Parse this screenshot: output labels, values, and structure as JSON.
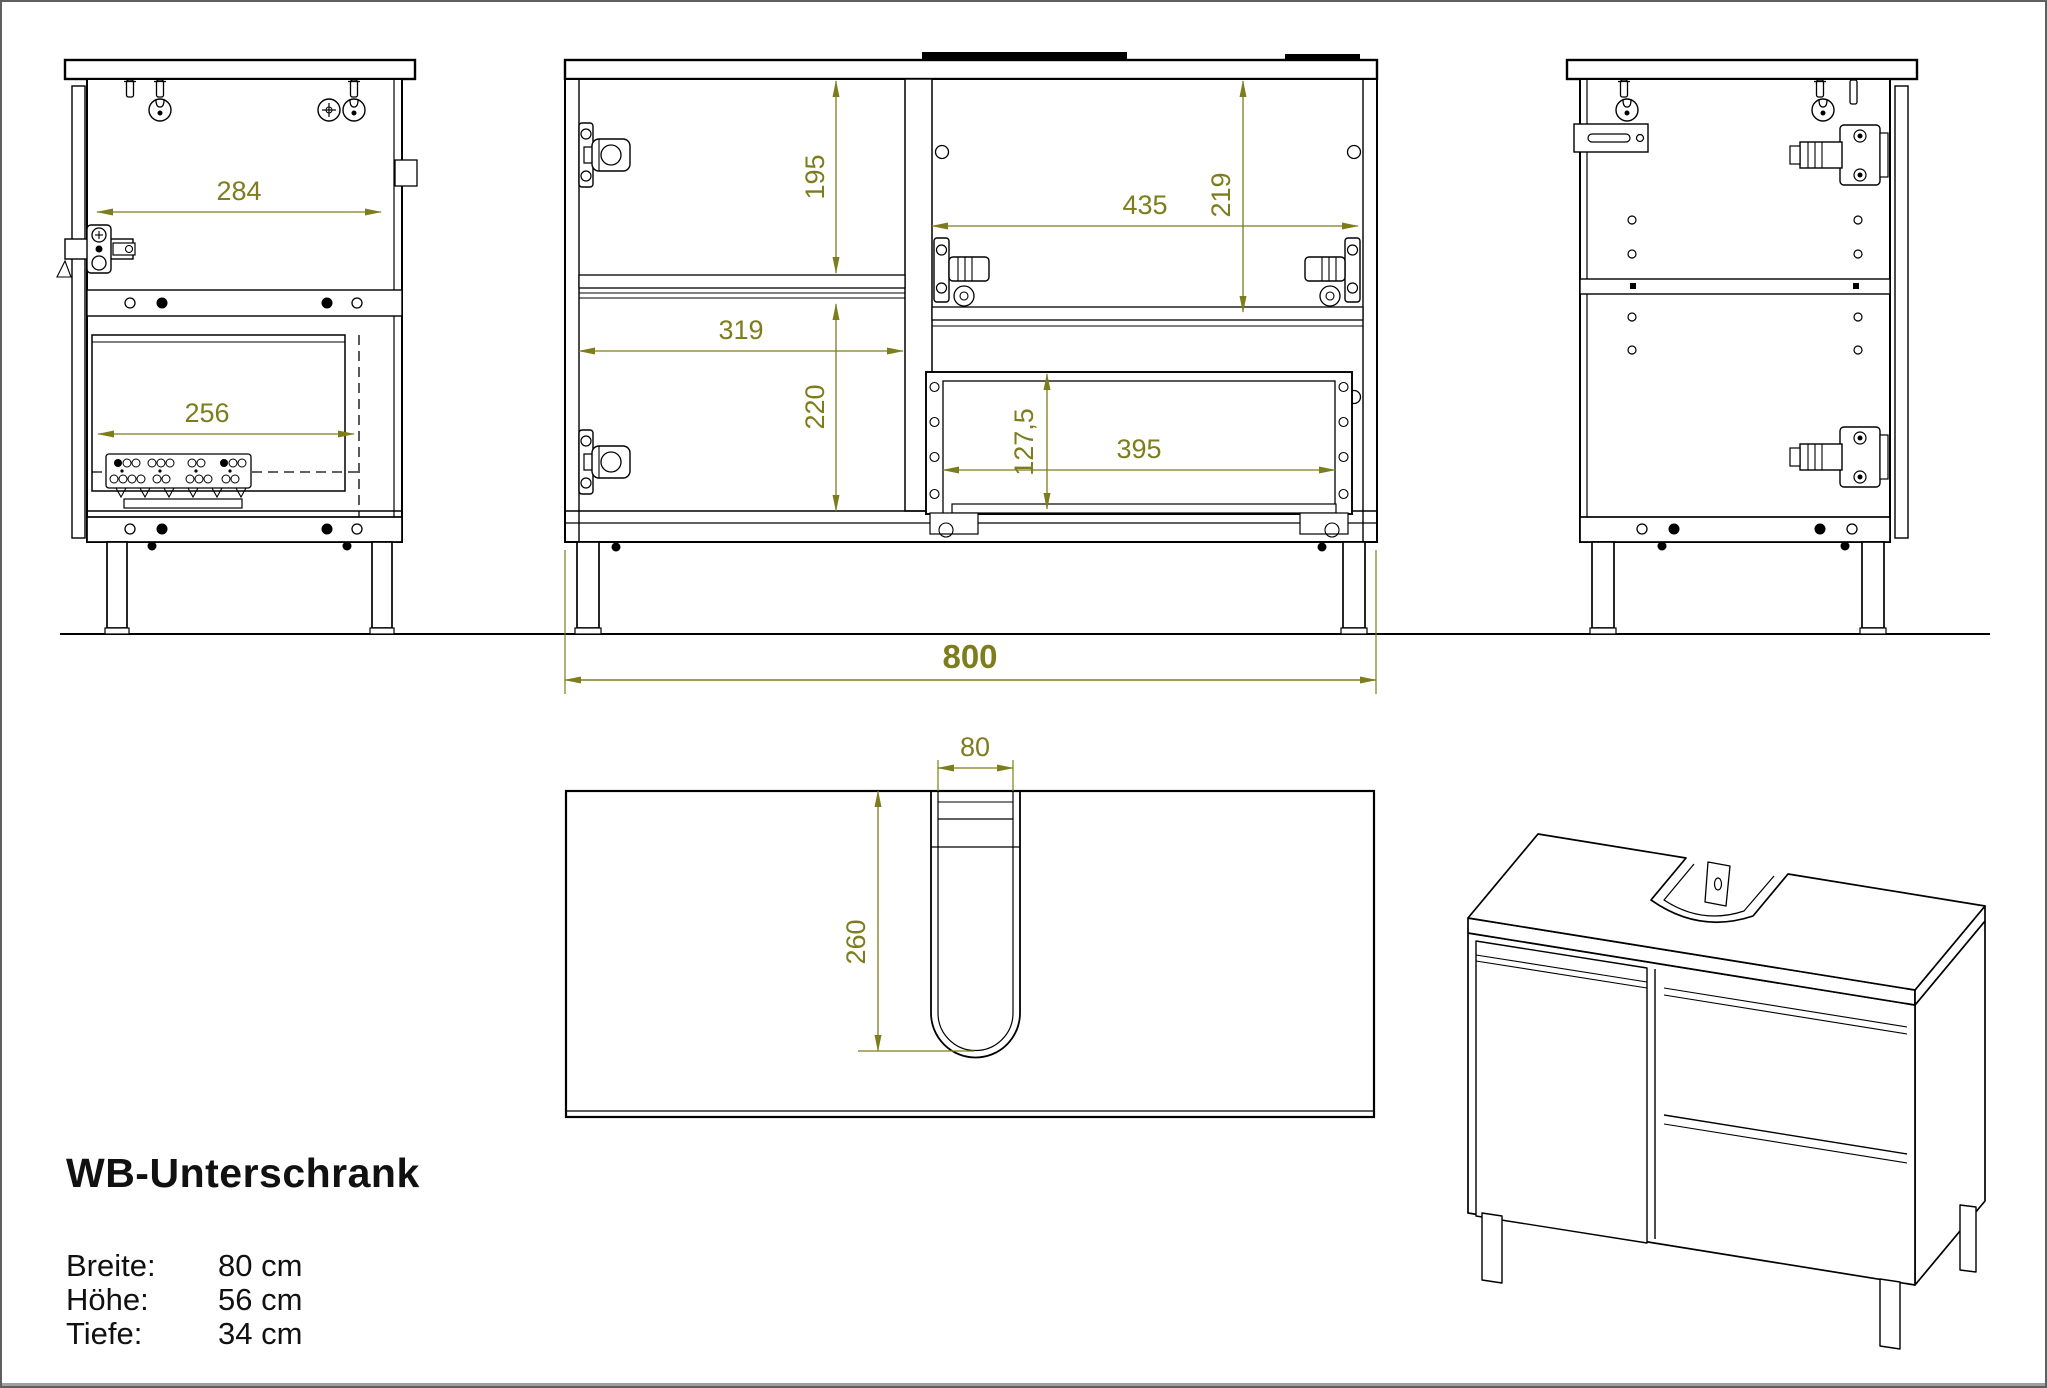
{
  "title_block": {
    "title": "WB-Unterschrank",
    "specs": [
      {
        "label": "Breite:",
        "value": "80 cm"
      },
      {
        "label": "Höhe:",
        "value": "56 cm"
      },
      {
        "label": "Tiefe:",
        "value": "34 cm"
      }
    ]
  },
  "dimensions": {
    "d284": "284",
    "d256": "256",
    "d195": "195",
    "d319": "319",
    "d220": "220",
    "d219": "219",
    "d435": "435",
    "d127_5": "127,5",
    "d395": "395",
    "d800": "800",
    "d80": "80",
    "d260": "260"
  },
  "colors": {
    "line": "#000000",
    "dimension": "#7d7d1d",
    "background": "#ffffff",
    "border": "#5f5f5f"
  }
}
